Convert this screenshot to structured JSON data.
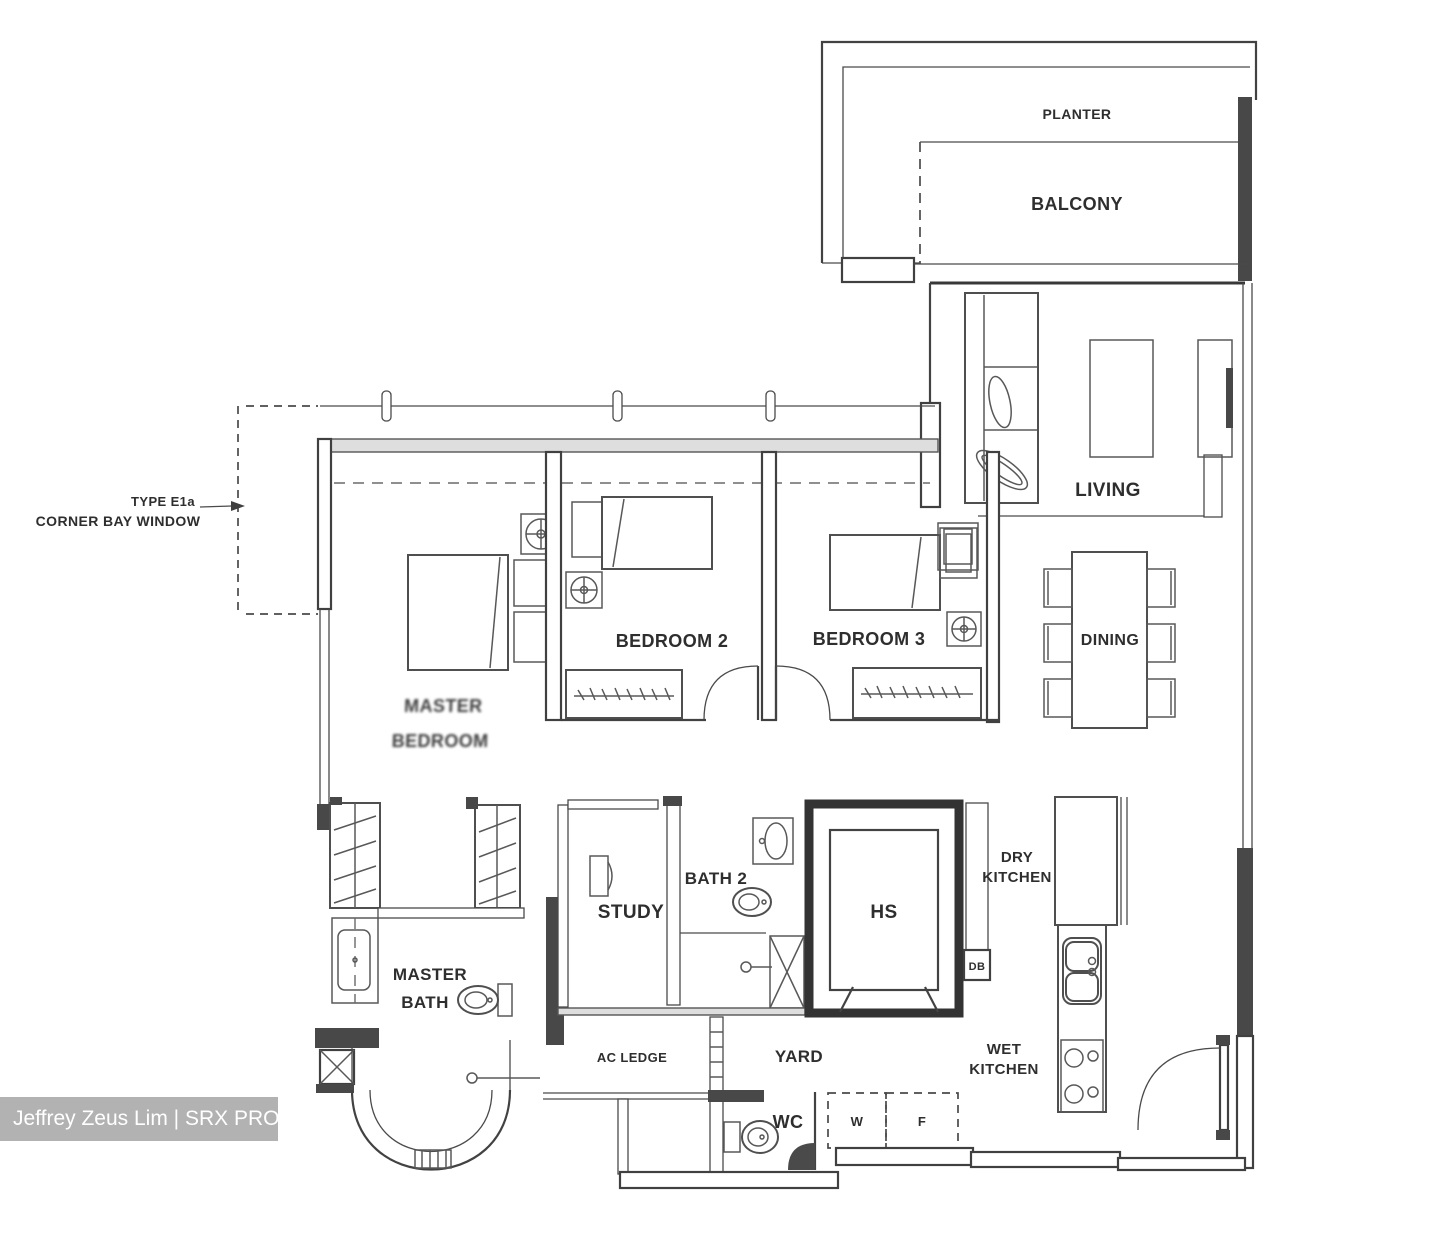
{
  "colors": {
    "line": "#474747",
    "wall_dark": "#4a4a4a",
    "background": "#ffffff",
    "watermark_bg": "#b2b2b2",
    "watermark_fg": "#ffffff"
  },
  "callout": {
    "line1": "TYPE E1a",
    "line2": "CORNER BAY WINDOW"
  },
  "rooms": {
    "planter": "PLANTER",
    "balcony": "BALCONY",
    "living": "LIVING",
    "dining": "DINING",
    "bedroom2": "BEDROOM 2",
    "bedroom3": "BEDROOM 3",
    "master_bedroom": {
      "line1": "MASTER",
      "line2": "BEDROOM"
    },
    "study": "STUDY",
    "bath2": "BATH 2",
    "hs": "HS",
    "master_bath": {
      "line1": "MASTER",
      "line2": "BATH"
    },
    "dry_kitchen": {
      "line1": "DRY",
      "line2": "KITCHEN"
    },
    "wet_kitchen": {
      "line1": "WET",
      "line2": "KITCHEN"
    },
    "yard": "YARD",
    "ac_ledge": "AC LEDGE",
    "wc": "WC"
  },
  "appliances": {
    "washer": "W",
    "fridge": "F",
    "db": "DB"
  },
  "watermark": {
    "text": "Jeffrey Zeus Lim | SRX PROPERTY"
  }
}
